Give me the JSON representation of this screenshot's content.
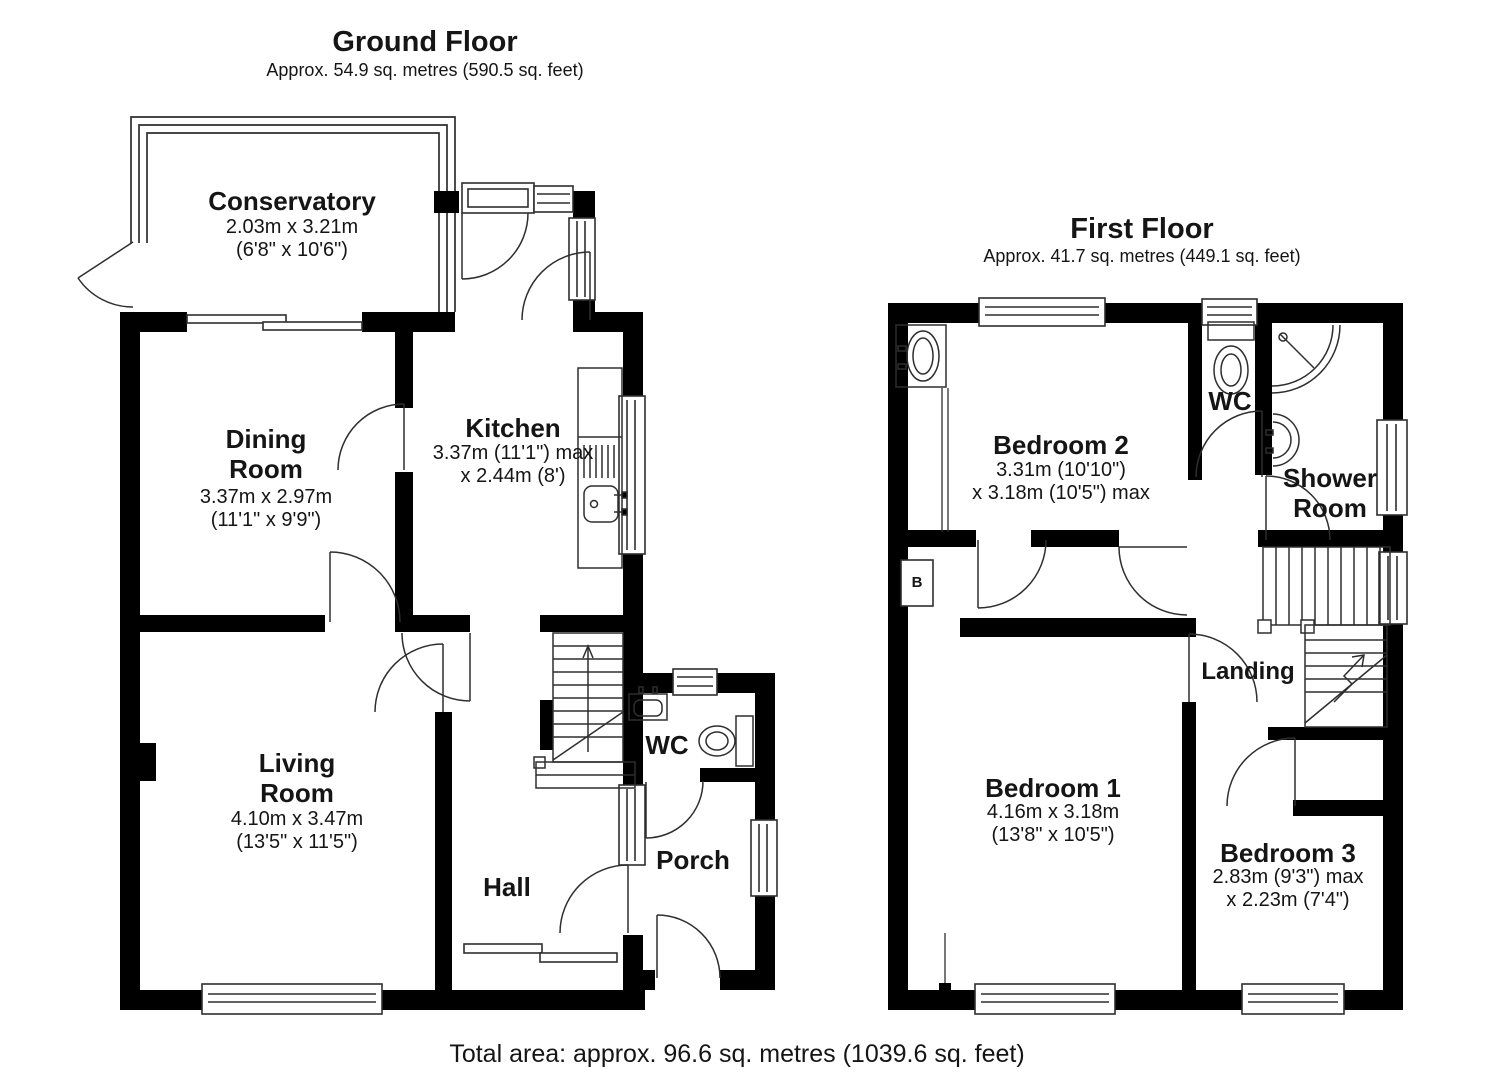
{
  "ground_floor": {
    "title": "Ground Floor",
    "subtitle": "Approx. 54.9 sq. metres (590.5 sq. feet)",
    "rooms": {
      "conservatory": {
        "name": "Conservatory",
        "dims_line1": "2.03m x 3.21m",
        "dims_line2": "(6'8\" x 10'6\")"
      },
      "dining_room": {
        "name": "Dining Room",
        "dims_line1": "3.37m x 2.97m",
        "dims_line2": "(11'1\" x 9'9\")"
      },
      "kitchen": {
        "name": "Kitchen",
        "dims_line1": "3.37m (11'1\") max",
        "dims_line2": "x 2.44m (8')"
      },
      "living_room": {
        "name": "Living Room",
        "dims_line1": "4.10m x 3.47m",
        "dims_line2": "(13'5\" x 11'5\")"
      },
      "hall": {
        "name": "Hall"
      },
      "wc": {
        "name": "WC"
      },
      "porch": {
        "name": "Porch"
      }
    }
  },
  "first_floor": {
    "title": "First Floor",
    "subtitle": "Approx. 41.7 sq. metres (449.1 sq. feet)",
    "boiler_label": "B",
    "rooms": {
      "bedroom_2": {
        "name": "Bedroom 2",
        "dims_line1": "3.31m (10'10\")",
        "dims_line2": "x 3.18m (10'5\") max"
      },
      "wc": {
        "name": "WC"
      },
      "shower_room": {
        "name": "Shower Room"
      },
      "landing": {
        "name": "Landing"
      },
      "bedroom_1": {
        "name": "Bedroom 1",
        "dims_line1": "4.16m x 3.18m",
        "dims_line2": "(13'8\" x 10'5\")"
      },
      "bedroom_3": {
        "name": "Bedroom 3",
        "dims_line1": "2.83m (9'3\") max",
        "dims_line2": "x 2.23m (7'4\")"
      }
    }
  },
  "footer": {
    "total_area": "Total area: approx. 96.6 sq. metres (1039.6 sq. feet)"
  },
  "colors": {
    "wall": "#000000",
    "background": "#ffffff",
    "detail_line": "#2e2e2e"
  }
}
